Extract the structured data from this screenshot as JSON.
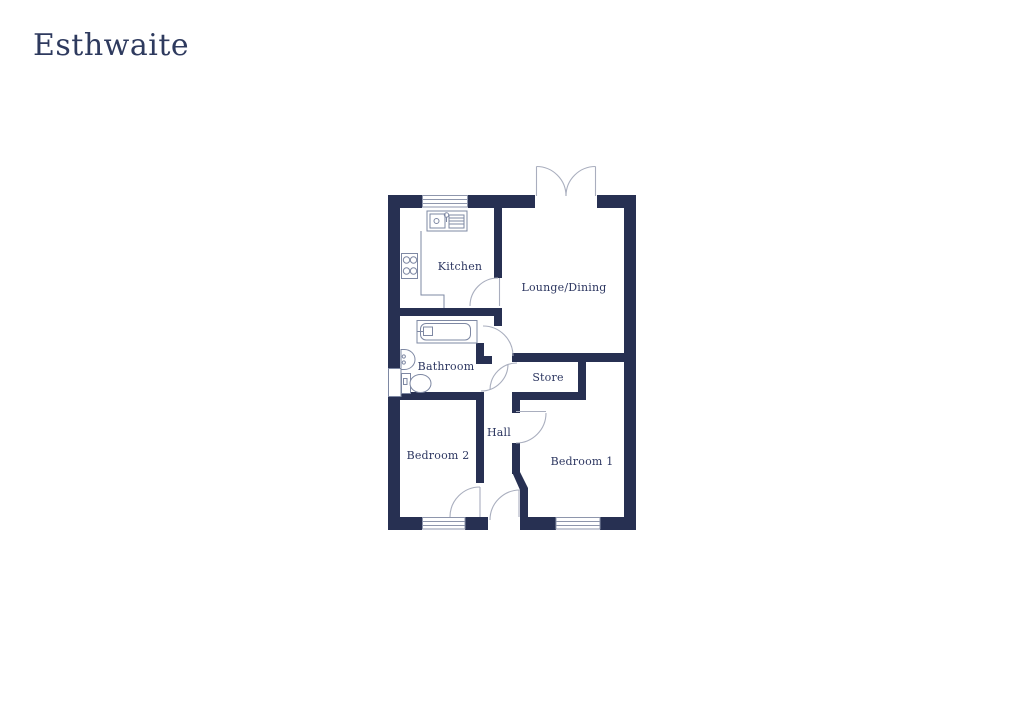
{
  "header": {
    "title": "Esthwaite"
  },
  "floorplan": {
    "colors": {
      "wall": "#273052",
      "fixture_line": "#7e88a3",
      "arc_line": "#a9aebe",
      "window_line": "#8e96ac",
      "label_text": "#2c3660",
      "title_color": "#2e3a5e"
    },
    "rooms": [
      {
        "id": "kitchen",
        "label": "Kitchen"
      },
      {
        "id": "lounge-dining",
        "label": "Lounge/Dining"
      },
      {
        "id": "bathroom",
        "label": "Bathroom"
      },
      {
        "id": "store",
        "label": "Store"
      },
      {
        "id": "hall",
        "label": "Hall"
      },
      {
        "id": "bedroom-2",
        "label": "Bedroom 2"
      },
      {
        "id": "bedroom-1",
        "label": "Bedroom 1"
      }
    ],
    "fixtures": [
      "kitchen-sink-icon",
      "hob-icon",
      "bath-icon",
      "basin-icon",
      "toilet-icon"
    ],
    "windows": [
      "kitchen-window",
      "bedroom2-window",
      "bedroom1-window"
    ],
    "doors": [
      "french-doors-lounge",
      "kitchen-door",
      "lounge-door",
      "bathroom-door",
      "store-door",
      "bedroom1-door",
      "bedroom2-door",
      "front-door"
    ]
  }
}
